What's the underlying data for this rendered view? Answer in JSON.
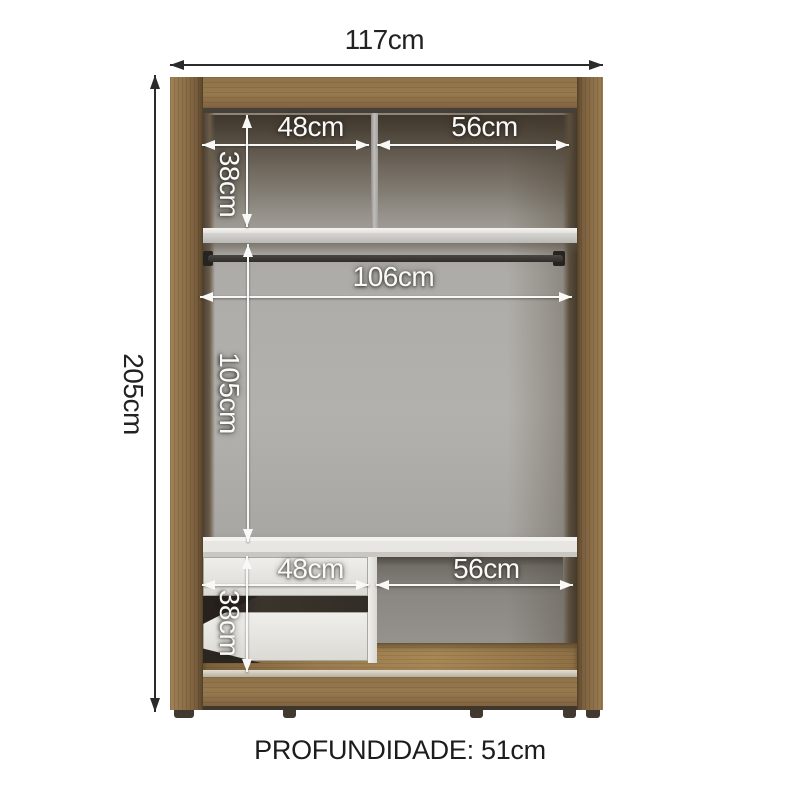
{
  "diagram": {
    "depth": "PROFUNDIDADE: 51cm",
    "dims": {
      "total_width": "117cm",
      "total_height": "205cm",
      "top_left_width": "48cm",
      "top_right_width": "56cm",
      "top_height": "38cm",
      "mid_width": "106cm",
      "mid_height": "105cm",
      "bottom_left_width": "48cm",
      "bottom_right_width": "56cm",
      "bottom_height": "38cm"
    },
    "colors": {
      "wood": "#8d7049",
      "wood_dark": "#58452c",
      "interior_gray": "#aeaca8",
      "shelf": "#eae8e4",
      "dim_white": "#f8f8f7",
      "dim_black": "#2b2b2b",
      "background": "#ffffff"
    }
  }
}
